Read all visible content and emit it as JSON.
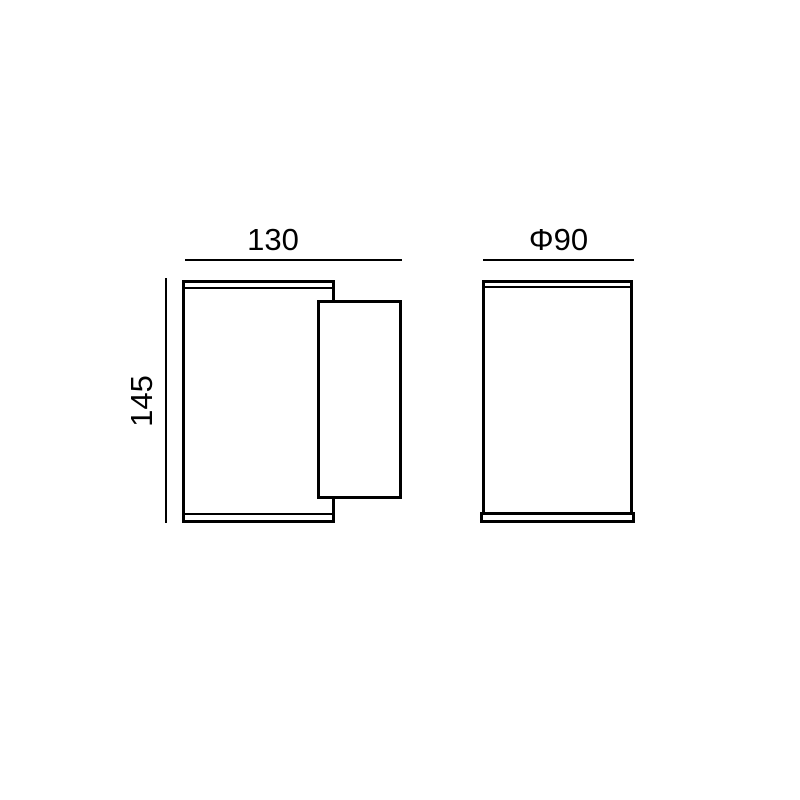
{
  "drawing": {
    "background_color": "#ffffff",
    "line_color": "#000000",
    "side_view": {
      "width_label": "130",
      "height_label": "145"
    },
    "front_view": {
      "diameter_label": "Φ90"
    }
  }
}
